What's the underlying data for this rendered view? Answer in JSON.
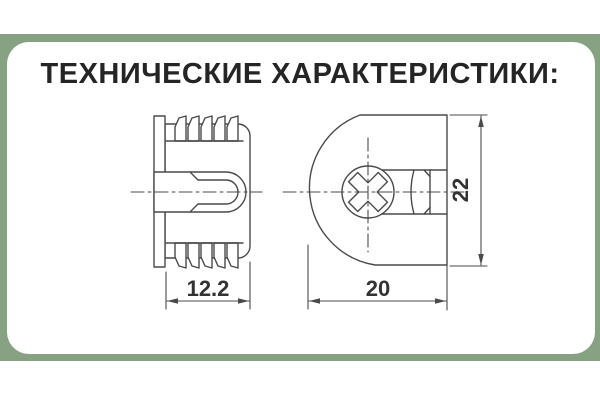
{
  "title": "ТЕХНИЧЕСКИЕ ХАРАКТЕРИСТИКИ:",
  "frame": {
    "band_color": "#87a283",
    "card_color": "#ffffff"
  },
  "diagram": {
    "type": "technical-drawing",
    "subject": "eccentric cam furniture connector shown in side view and front view",
    "line_color": "#4a4a4a",
    "text_color": "#333333",
    "side_view": {
      "depth_label": "12.2"
    },
    "front_view": {
      "width_label": "20",
      "height_label": "22"
    }
  }
}
